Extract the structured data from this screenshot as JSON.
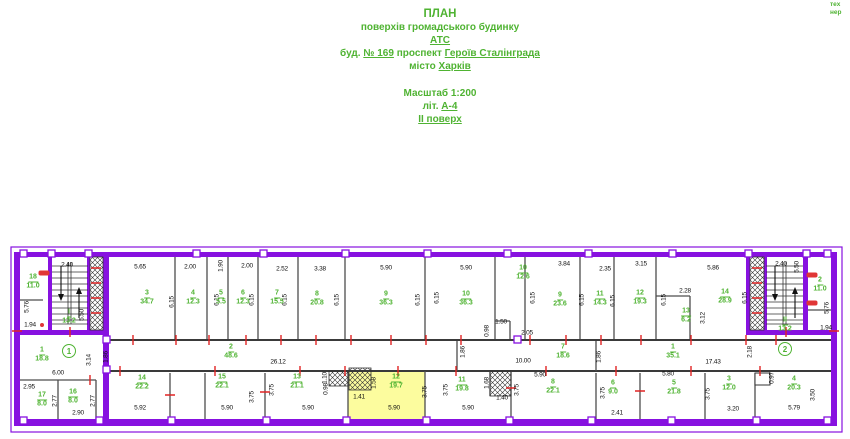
{
  "title": {
    "line1": "ПЛАН",
    "line2": "поверхів громадського будинку",
    "line3": "АТС",
    "line4_pre": "буд. ",
    "line4_num": "№ 169",
    "line4_mid": " проспект ",
    "line4_street": "Героїв Сталінграда",
    "line5_pre": "місто ",
    "line5_city": "Харків",
    "scale": "Масштаб 1:200",
    "lit_pre": "літ. ",
    "lit": "А-4",
    "floor": "ІІ поверх"
  },
  "corner_note": {
    "line1": "тех",
    "line2": "нер"
  },
  "colors": {
    "wall_purple": "#8711E0",
    "label_green": "#4FB332",
    "tick_red": "#E02424",
    "highlight_yellow": "#FCFC9E",
    "dimension_black": "#101010"
  },
  "plan": {
    "room_labels": [
      {
        "num": "18",
        "area": "11.0",
        "x": 33,
        "y": 282
      },
      {
        "num": "І",
        "area": "13.2",
        "x": 69,
        "y": 317
      },
      {
        "num": "3",
        "area": "34.7",
        "x": 147,
        "y": 298
      },
      {
        "num": "4",
        "area": "12.3",
        "x": 193,
        "y": 298
      },
      {
        "num": "5",
        "area": "5.5",
        "x": 221,
        "y": 298
      },
      {
        "num": "6",
        "area": "12.3",
        "x": 243,
        "y": 298
      },
      {
        "num": "7",
        "area": "15.5",
        "x": 277,
        "y": 298
      },
      {
        "num": "8",
        "area": "20.8",
        "x": 317,
        "y": 299
      },
      {
        "num": "9",
        "area": "36.3",
        "x": 386,
        "y": 299
      },
      {
        "num": "10",
        "area": "36.3",
        "x": 466,
        "y": 299
      },
      {
        "num": "10",
        "area": "12.6",
        "x": 523,
        "y": 273
      },
      {
        "num": "9",
        "area": "23.6",
        "x": 560,
        "y": 300
      },
      {
        "num": "11",
        "area": "14.3",
        "x": 600,
        "y": 299
      },
      {
        "num": "12",
        "area": "19.3",
        "x": 640,
        "y": 298
      },
      {
        "num": "13",
        "area": "6.2",
        "x": 686,
        "y": 316
      },
      {
        "num": "14",
        "area": "28.9",
        "x": 725,
        "y": 297
      },
      {
        "num": "ІІ",
        "area": "13.2",
        "x": 785,
        "y": 325
      },
      {
        "num": "2",
        "area": "11.0",
        "x": 820,
        "y": 285
      },
      {
        "num": "2",
        "area": "48.6",
        "x": 231,
        "y": 352
      },
      {
        "num": "1",
        "area": "18.8",
        "x": 42,
        "y": 355
      },
      {
        "num": "7",
        "area": "18.6",
        "x": 563,
        "y": 352
      },
      {
        "num": "1",
        "area": "35.1",
        "x": 673,
        "y": 352
      },
      {
        "num": "14",
        "area": "22.2",
        "x": 142,
        "y": 383
      },
      {
        "num": "15",
        "area": "22.1",
        "x": 222,
        "y": 382
      },
      {
        "num": "13",
        "area": "21.1",
        "x": 297,
        "y": 382
      },
      {
        "num": "12",
        "area": "19.7",
        "x": 396,
        "y": 382
      },
      {
        "num": "11",
        "area": "19.8",
        "x": 462,
        "y": 385
      },
      {
        "num": "8",
        "area": "22.1",
        "x": 553,
        "y": 387
      },
      {
        "num": "6",
        "area": "9.0",
        "x": 613,
        "y": 388
      },
      {
        "num": "5",
        "area": "21.8",
        "x": 674,
        "y": 388
      },
      {
        "num": "3",
        "area": "12.0",
        "x": 729,
        "y": 384
      },
      {
        "num": "4",
        "area": "20.3",
        "x": 794,
        "y": 384
      },
      {
        "num": "17",
        "area": "8.0",
        "x": 42,
        "y": 400
      },
      {
        "num": "16",
        "area": "8.0",
        "x": 73,
        "y": 397
      }
    ],
    "dimensions": [
      {
        "t": "2.40",
        "x": 67,
        "y": 265
      },
      {
        "t": "5.65",
        "x": 140,
        "y": 267
      },
      {
        "t": "2.00",
        "x": 190,
        "y": 267
      },
      {
        "t": "1.90",
        "x": 221,
        "y": 266,
        "r": "v"
      },
      {
        "t": "2.00",
        "x": 247,
        "y": 266
      },
      {
        "t": "2.52",
        "x": 282,
        "y": 269
      },
      {
        "t": "3.38",
        "x": 320,
        "y": 269
      },
      {
        "t": "5.90",
        "x": 386,
        "y": 268
      },
      {
        "t": "5.90",
        "x": 466,
        "y": 268
      },
      {
        "t": "3.84",
        "x": 564,
        "y": 264
      },
      {
        "t": "2.35",
        "x": 605,
        "y": 269
      },
      {
        "t": "3.15",
        "x": 641,
        "y": 264
      },
      {
        "t": "5.86",
        "x": 713,
        "y": 268
      },
      {
        "t": "2.40",
        "x": 781,
        "y": 264
      },
      {
        "t": "5.50",
        "x": 82,
        "y": 315,
        "r": "v"
      },
      {
        "t": "5.50",
        "x": 797,
        "y": 267,
        "r": "v"
      },
      {
        "t": "5.76",
        "x": 27,
        "y": 307,
        "r": "v"
      },
      {
        "t": "5.76",
        "x": 827,
        "y": 308,
        "r": "v"
      },
      {
        "t": "1.94",
        "x": 30,
        "y": 325
      },
      {
        "t": "1.94",
        "x": 826,
        "y": 328
      },
      {
        "t": "6.15",
        "x": 172,
        "y": 302,
        "r": "v"
      },
      {
        "t": "6.15",
        "x": 217,
        "y": 300,
        "r": "v"
      },
      {
        "t": "6.15",
        "x": 252,
        "y": 300,
        "r": "v"
      },
      {
        "t": "6.15",
        "x": 285,
        "y": 300,
        "r": "v"
      },
      {
        "t": "6.15",
        "x": 337,
        "y": 300,
        "r": "v"
      },
      {
        "t": "6.15",
        "x": 418,
        "y": 300,
        "r": "v"
      },
      {
        "t": "6.15",
        "x": 437,
        "y": 298,
        "r": "v"
      },
      {
        "t": "6.15",
        "x": 533,
        "y": 298,
        "r": "v"
      },
      {
        "t": "6.15",
        "x": 582,
        "y": 300,
        "r": "v"
      },
      {
        "t": "6.15",
        "x": 613,
        "y": 301,
        "r": "v"
      },
      {
        "t": "6.15",
        "x": 664,
        "y": 300,
        "r": "v"
      },
      {
        "t": "6.15",
        "x": 745,
        "y": 298,
        "r": "v"
      },
      {
        "t": "1.50",
        "x": 501,
        "y": 322
      },
      {
        "t": "0.98",
        "x": 487,
        "y": 331,
        "r": "v"
      },
      {
        "t": "2.05",
        "x": 527,
        "y": 333
      },
      {
        "t": "2.28",
        "x": 685,
        "y": 291
      },
      {
        "t": "3.12",
        "x": 703,
        "y": 318,
        "r": "v"
      },
      {
        "t": "1.86",
        "x": 106,
        "y": 357,
        "r": "v"
      },
      {
        "t": "1.86",
        "x": 463,
        "y": 352,
        "r": "v"
      },
      {
        "t": "1.86",
        "x": 599,
        "y": 357,
        "r": "v"
      },
      {
        "t": "3.14",
        "x": 89,
        "y": 360,
        "r": "v"
      },
      {
        "t": "2.18",
        "x": 750,
        "y": 352,
        "r": "v"
      },
      {
        "t": "26.12",
        "x": 278,
        "y": 362
      },
      {
        "t": "10.00",
        "x": 523,
        "y": 361
      },
      {
        "t": "17.43",
        "x": 713,
        "y": 362
      },
      {
        "t": "6.00",
        "x": 58,
        "y": 373
      },
      {
        "t": "2.95",
        "x": 29,
        "y": 387
      },
      {
        "t": "2.77",
        "x": 55,
        "y": 401,
        "r": "v"
      },
      {
        "t": "2.77",
        "x": 93,
        "y": 401,
        "r": "v"
      },
      {
        "t": "2.90",
        "x": 78,
        "y": 413
      },
      {
        "t": "5.92",
        "x": 140,
        "y": 408
      },
      {
        "t": "5.90",
        "x": 227,
        "y": 408
      },
      {
        "t": "3.75",
        "x": 252,
        "y": 397,
        "r": "v"
      },
      {
        "t": "3.75",
        "x": 272,
        "y": 390,
        "r": "v"
      },
      {
        "t": "5.90",
        "x": 308,
        "y": 408
      },
      {
        "t": "1.10",
        "x": 325,
        "y": 378,
        "r": "v"
      },
      {
        "t": "0.98",
        "x": 326,
        "y": 389,
        "r": "v"
      },
      {
        "t": "1.41",
        "x": 359,
        "y": 397
      },
      {
        "t": "1.58",
        "x": 374,
        "y": 383,
        "r": "v"
      },
      {
        "t": "5.90",
        "x": 394,
        "y": 408
      },
      {
        "t": "3.75",
        "x": 425,
        "y": 392,
        "r": "v"
      },
      {
        "t": "3.75",
        "x": 446,
        "y": 390,
        "r": "v"
      },
      {
        "t": "1.68",
        "x": 487,
        "y": 383,
        "r": "v"
      },
      {
        "t": "1.40",
        "x": 502,
        "y": 398
      },
      {
        "t": "3.75",
        "x": 517,
        "y": 390,
        "r": "v"
      },
      {
        "t": "5.90",
        "x": 468,
        "y": 408
      },
      {
        "t": "5.90",
        "x": 540,
        "y": 375
      },
      {
        "t": "3.75",
        "x": 603,
        "y": 393,
        "r": "v"
      },
      {
        "t": "2.41",
        "x": 617,
        "y": 413
      },
      {
        "t": "5.80",
        "x": 668,
        "y": 374
      },
      {
        "t": "3.75",
        "x": 708,
        "y": 394,
        "r": "v"
      },
      {
        "t": "3.20",
        "x": 733,
        "y": 409
      },
      {
        "t": "5.79",
        "x": 794,
        "y": 408
      },
      {
        "t": "3.50",
        "x": 813,
        "y": 395,
        "r": "v"
      },
      {
        "t": "0.97",
        "x": 772,
        "y": 378,
        "r": "v"
      }
    ],
    "axis_markers": [
      {
        "label": "1",
        "x": 69,
        "y": 351
      },
      {
        "label": "2",
        "x": 785,
        "y": 349
      }
    ],
    "red_tags": [
      {
        "x": 44,
        "y": 273,
        "w": 11,
        "h": 5
      },
      {
        "x": 812,
        "y": 275,
        "w": 11,
        "h": 5
      },
      {
        "x": 812,
        "y": 303,
        "w": 11,
        "h": 5
      },
      {
        "x": 42,
        "y": 325,
        "w": 4,
        "h": 4
      }
    ]
  }
}
